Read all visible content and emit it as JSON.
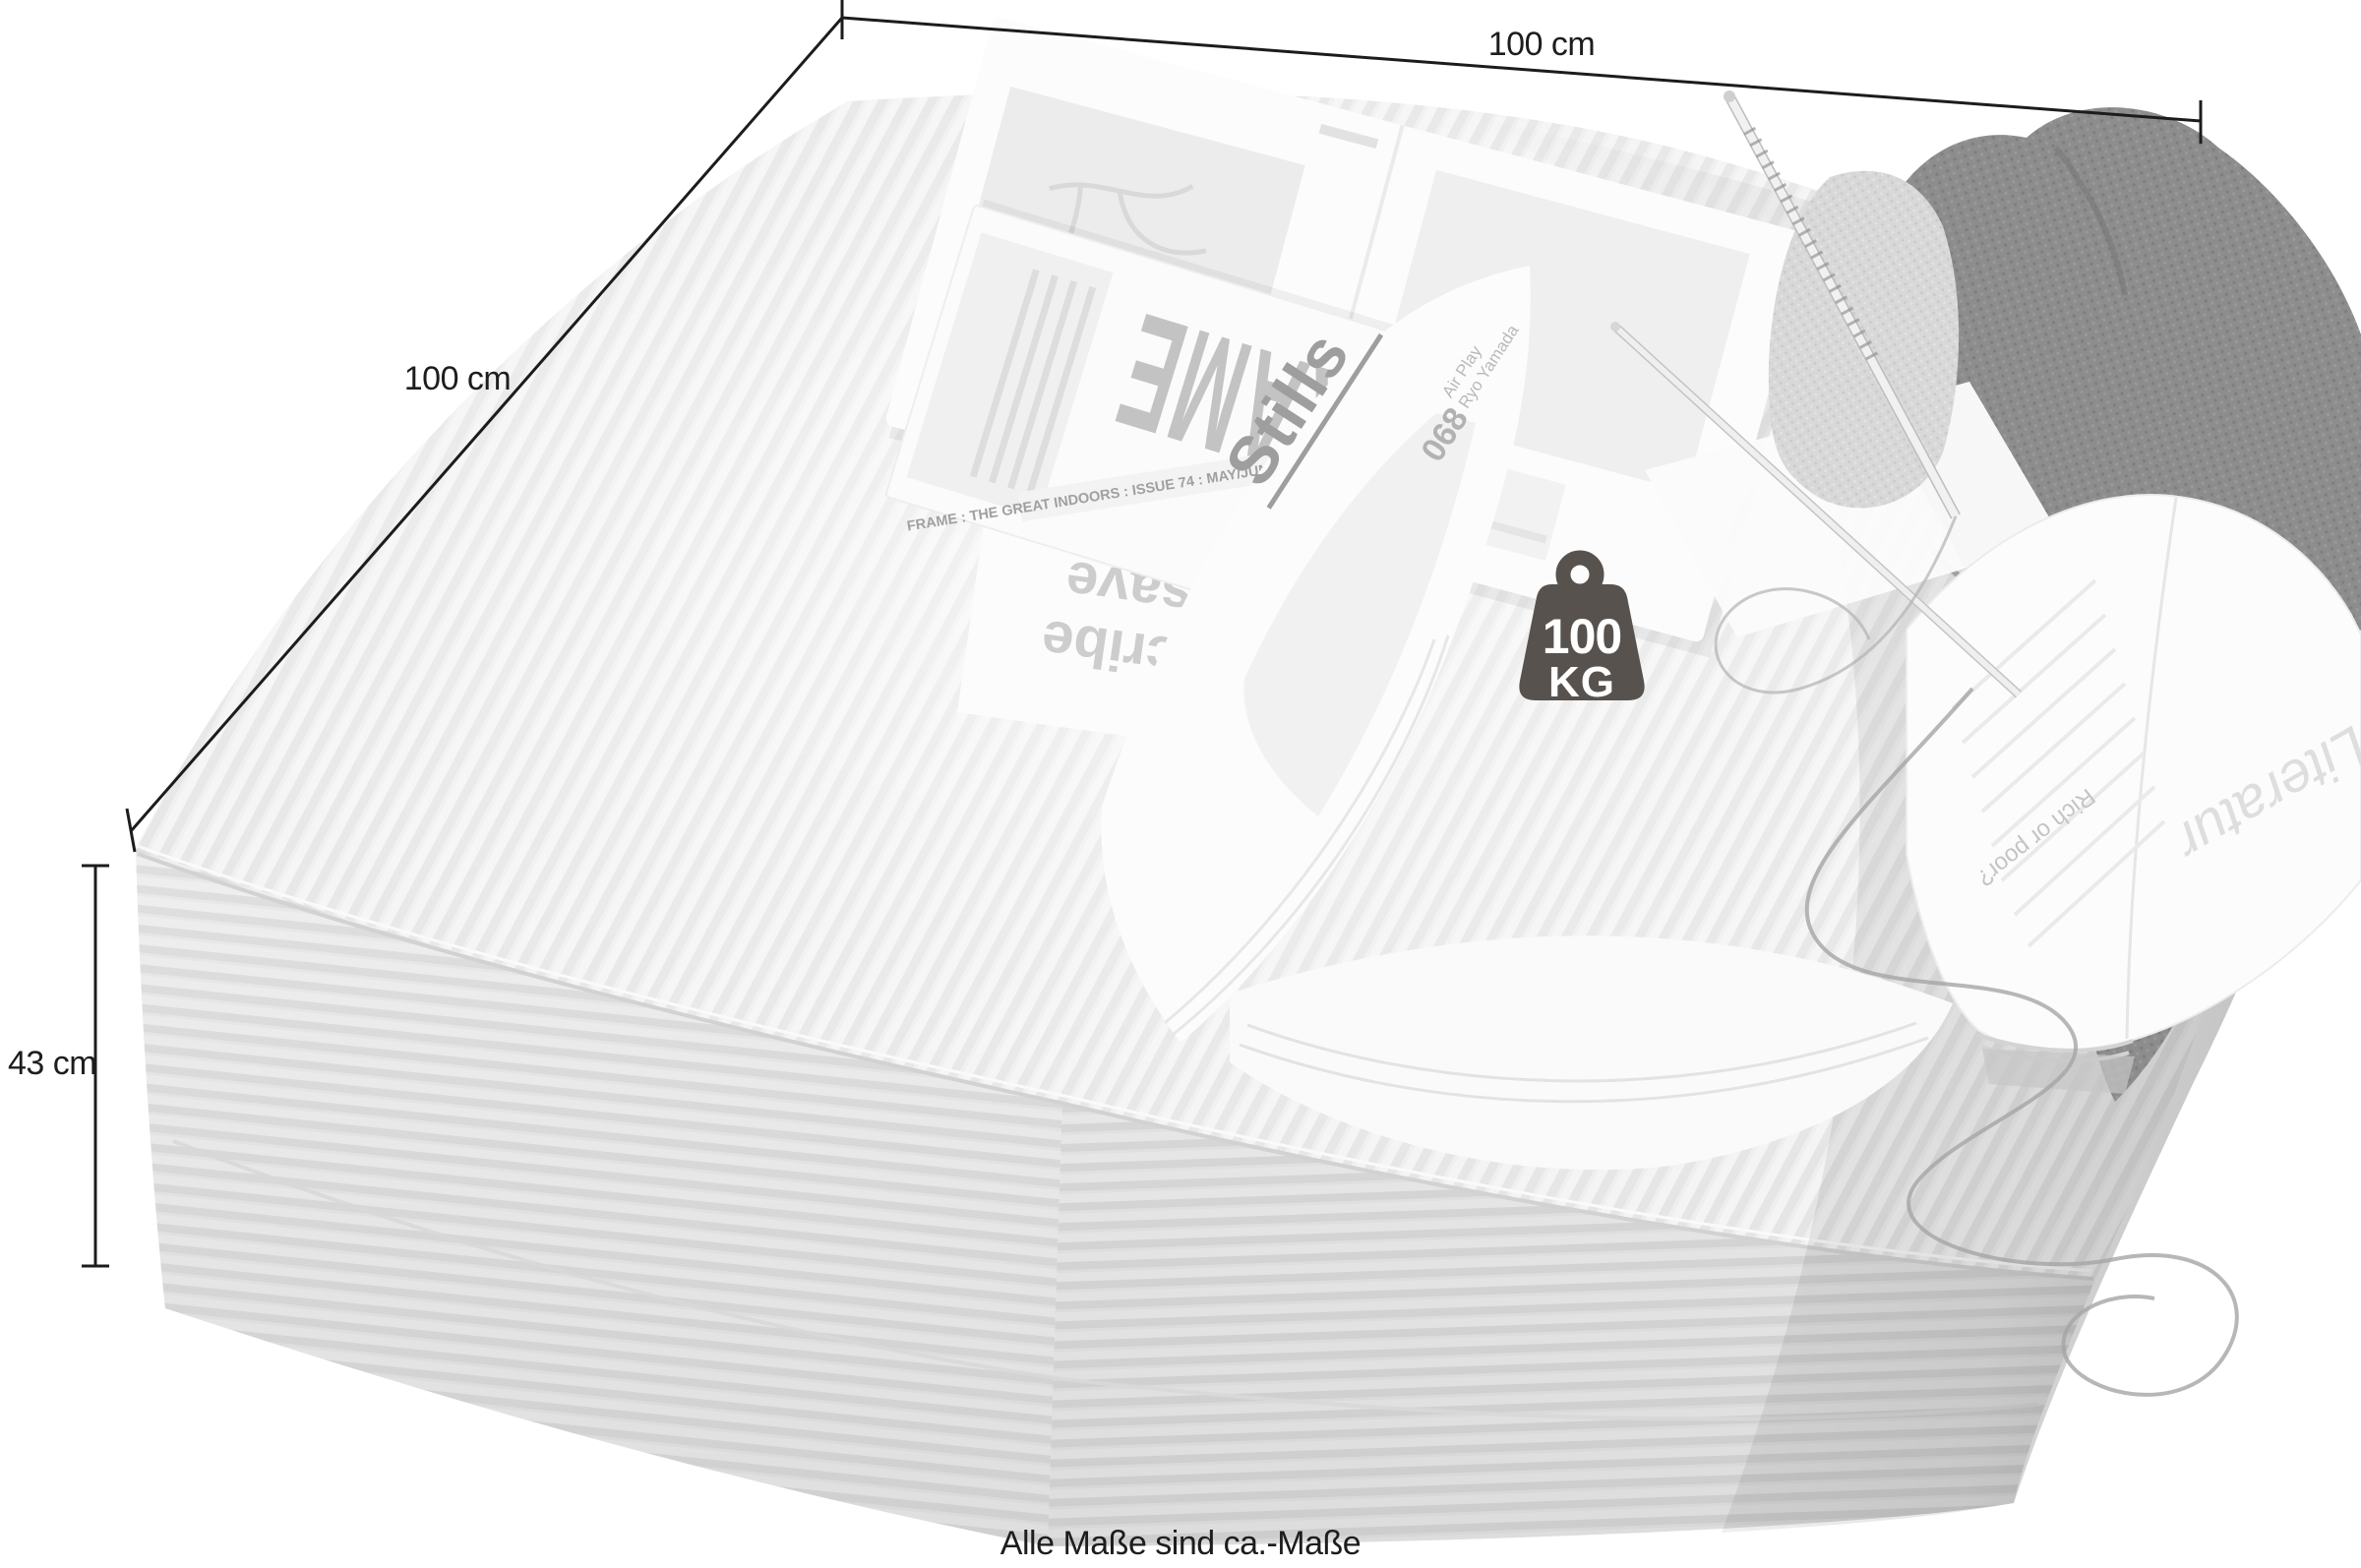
{
  "annotations": {
    "width_label": "100 cm",
    "depth_label": "100 cm",
    "height_label": "43 cm",
    "footnote": "Alle Maße sind ca.-Maße"
  },
  "weight_badge": {
    "value": "100",
    "unit": "KG"
  },
  "props": {
    "frame_magazine": {
      "title": "FRAME",
      "spine": "FRAME : THE GREAT INDOORS : ISSUE 74 : MAY/JUN 2010 : TRAVEL, TALES"
    },
    "stills_magazine": {
      "title": "Stills",
      "page_number": "068",
      "article": "Air Play",
      "author": "Ryo Yamada"
    },
    "insert_page": {
      "line1": "Subscribe",
      "line2": "and save"
    },
    "open_book": {
      "heading": "Rich or poor?",
      "script": "Literatur"
    }
  },
  "colors": {
    "line": "#1c1c1c",
    "text": "#1d1d1d",
    "badge": "#57524e",
    "fabric_light": "#f3f3f3",
    "fabric_rib": "#e2e2e2",
    "sweater": "#8d8d8d",
    "prop_text": "#bdbdbd"
  }
}
